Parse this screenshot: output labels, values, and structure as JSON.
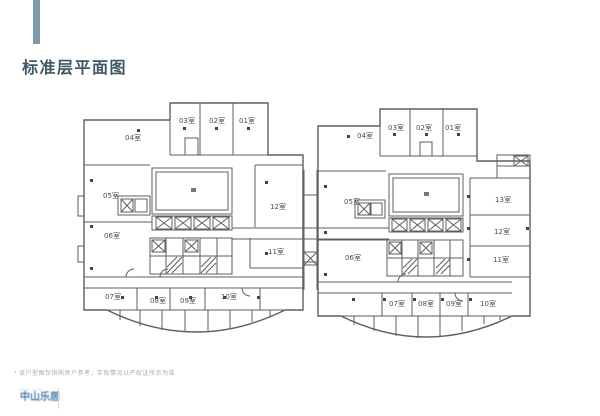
{
  "page": {
    "title": "标准层平面图"
  },
  "plan": {
    "left_wing": {
      "rooms": [
        "01室",
        "02室",
        "03室",
        "04室",
        "05室",
        "06室",
        "07室",
        "08室",
        "09室",
        "10室",
        "11室",
        "12室"
      ]
    },
    "right_wing": {
      "rooms": [
        "01室",
        "02室",
        "03室",
        "04室",
        "05室",
        "06室",
        "07室",
        "08室",
        "09室",
        "10室",
        "11室",
        "12室",
        "13室"
      ]
    }
  },
  "footer": {
    "note": "* 该户型图仅供购房户参考，实际情况以产权证所示为准",
    "logo_text": "中山乐居",
    "logo_subtext": "leju.com"
  },
  "colors": {
    "accent_bar": "#7e99ac",
    "title_text": "#3f5764",
    "plan_line": "#5f5f5f"
  }
}
